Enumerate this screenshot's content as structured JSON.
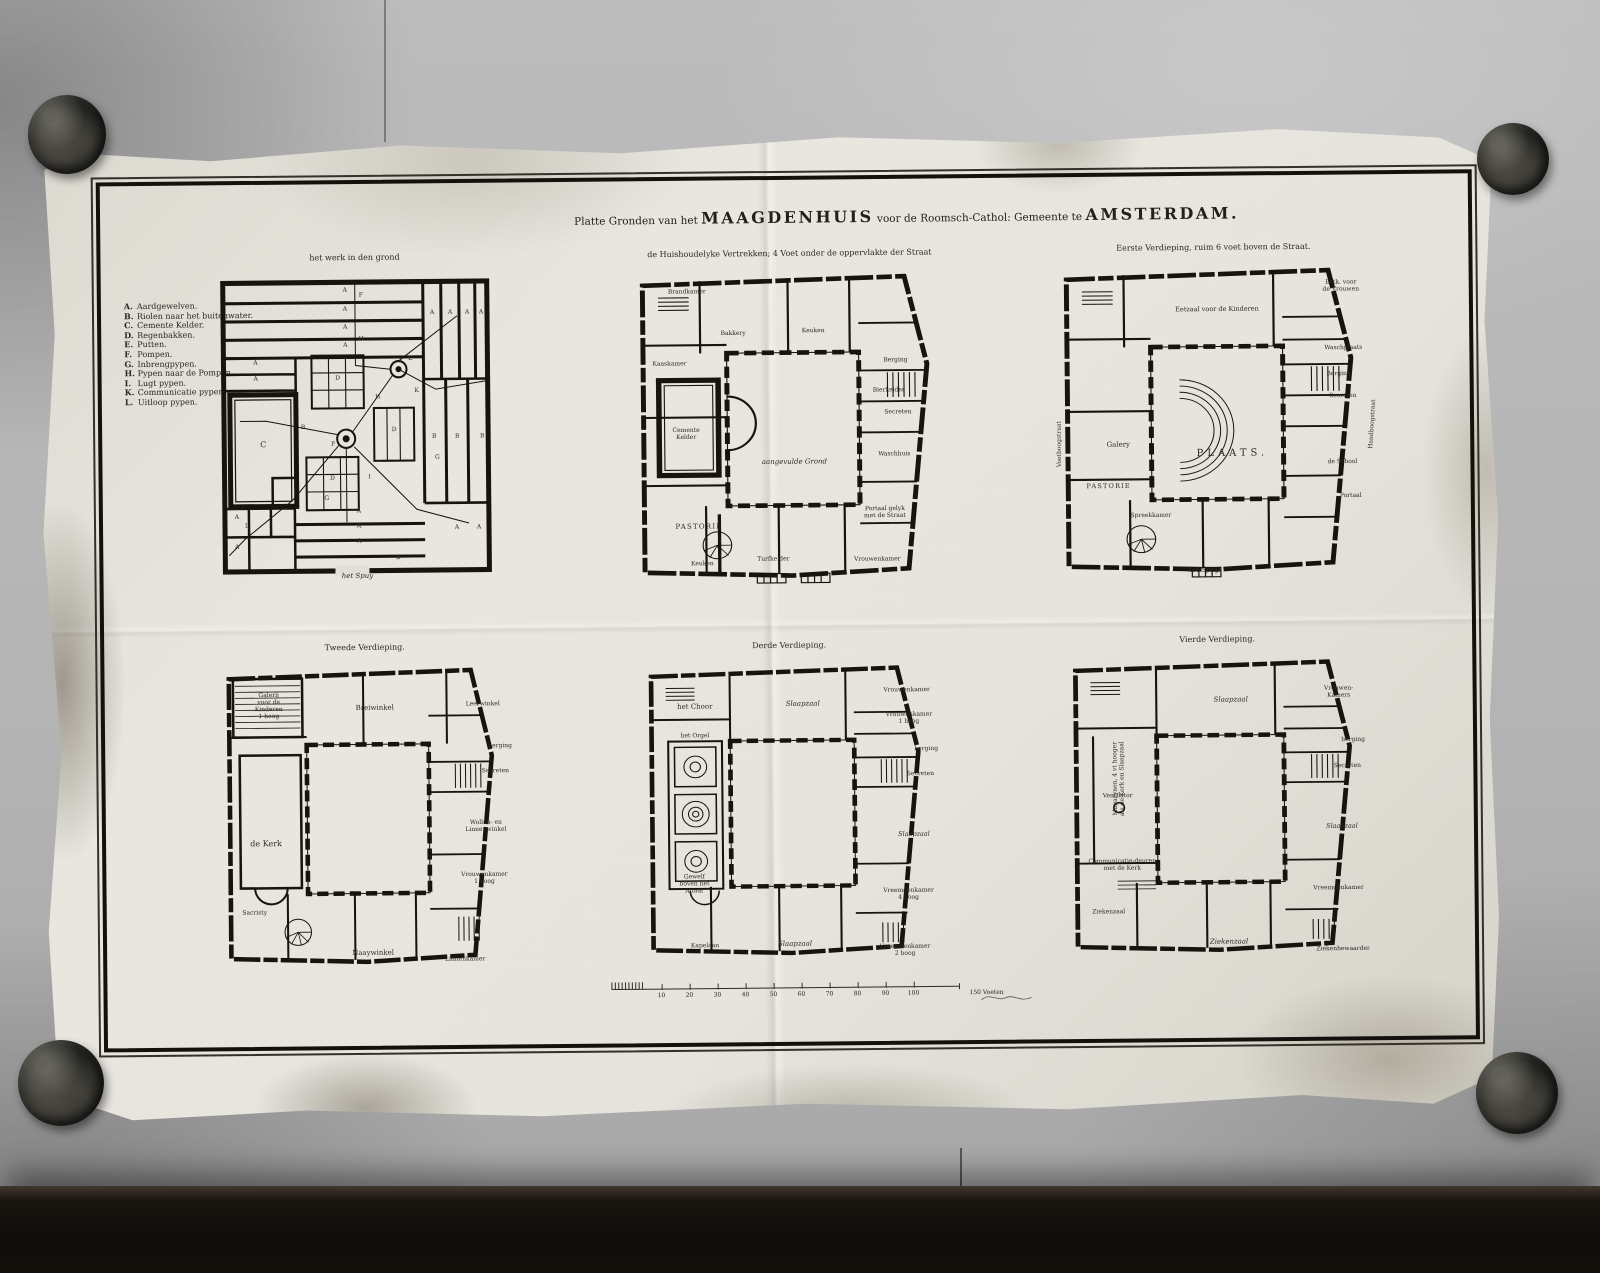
{
  "colors": {
    "paper": "#e7e5de",
    "ink": "#17140f",
    "wall": "#b4b4b4"
  },
  "sheet": {
    "title": {
      "part1": "Platte Gronden van het",
      "name1": "MAAGDENHUIS",
      "part2": "voor de Roomsch-Cathol: Gemeente te",
      "name2": "AMSTERDAM."
    },
    "legend": {
      "items": [
        {
          "key": "A.",
          "label": "Aardgewelven."
        },
        {
          "key": "B.",
          "label": "Riolen naar het buitenwater."
        },
        {
          "key": "C.",
          "label": "Cemente Kelder."
        },
        {
          "key": "D.",
          "label": "Regenbakken."
        },
        {
          "key": "E.",
          "label": "Putten."
        },
        {
          "key": "F.",
          "label": "Pompen."
        },
        {
          "key": "G.",
          "label": "Inbrengpypen."
        },
        {
          "key": "H.",
          "label": "Pypen naar de Pompen."
        },
        {
          "key": "I.",
          "label": "Lugt pypen."
        },
        {
          "key": "K.",
          "label": "Communicatie pypen."
        },
        {
          "key": "L.",
          "label": "Uitloop pypen."
        }
      ]
    },
    "plans": [
      {
        "title": "het werk in den grond",
        "labels": [
          {
            "t": "A",
            "x": 140,
            "y": 23
          },
          {
            "t": "A",
            "x": 140,
            "y": 42
          },
          {
            "t": "A",
            "x": 140,
            "y": 60
          },
          {
            "t": "A",
            "x": 140,
            "y": 78
          },
          {
            "t": "A",
            "x": 227,
            "y": 46
          },
          {
            "t": "A",
            "x": 245,
            "y": 46
          },
          {
            "t": "A",
            "x": 262,
            "y": 46
          },
          {
            "t": "A",
            "x": 276,
            "y": 46
          },
          {
            "t": "A",
            "x": 50,
            "y": 95
          },
          {
            "t": "A",
            "x": 50,
            "y": 111
          },
          {
            "t": "B",
            "x": 228,
            "y": 170
          },
          {
            "t": "B",
            "x": 251,
            "y": 170
          },
          {
            "t": "B",
            "x": 276,
            "y": 170
          },
          {
            "t": "B",
            "x": 97,
            "y": 160
          },
          {
            "t": "C",
            "x": 57,
            "y": 176,
            "fs": 8
          },
          {
            "t": "D",
            "x": 132,
            "y": 111
          },
          {
            "t": "D",
            "x": 126,
            "y": 211
          },
          {
            "t": "D",
            "x": 188,
            "y": 163
          },
          {
            "t": "E",
            "x": 205,
            "y": 92
          },
          {
            "t": "F",
            "x": 127,
            "y": 177
          },
          {
            "t": "F",
            "x": 156,
            "y": 28
          },
          {
            "t": "H",
            "x": 156,
            "y": 72
          },
          {
            "t": "G",
            "x": 120,
            "y": 231
          },
          {
            "t": "H",
            "x": 172,
            "y": 130
          },
          {
            "t": "K",
            "x": 211,
            "y": 124
          },
          {
            "t": "G",
            "x": 231,
            "y": 191
          },
          {
            "t": "L",
            "x": 40,
            "y": 258
          },
          {
            "t": "I",
            "x": 163,
            "y": 210
          },
          {
            "t": "A",
            "x": 152,
            "y": 244
          },
          {
            "t": "A",
            "x": 152,
            "y": 259
          },
          {
            "t": "A",
            "x": 152,
            "y": 274
          },
          {
            "t": "A",
            "x": 30,
            "y": 249
          },
          {
            "t": "A",
            "x": 30,
            "y": 279
          },
          {
            "t": "A",
            "x": 250,
            "y": 261
          },
          {
            "t": "A",
            "x": 272,
            "y": 261
          },
          {
            "t": "B",
            "x": 191,
            "y": 291
          },
          {
            "t": "het Spuy",
            "x": 150,
            "y": 308,
            "fs": 7,
            "cls": "it"
          }
        ]
      },
      {
        "title": "de Huishoudelyke Vertrekken; 4 Voet onder de oppervlakte der Straat",
        "labels": [
          {
            "t": "Brandkamer",
            "x": 62,
            "y": 28
          },
          {
            "t": "Bakkery",
            "x": 108,
            "y": 70
          },
          {
            "t": "Keuken",
            "x": 188,
            "y": 68
          },
          {
            "t": "Kaaskamer",
            "x": 44,
            "y": 100
          },
          {
            "t": "Berging",
            "x": 270,
            "y": 98
          },
          {
            "t": "Bierkelder",
            "x": 263,
            "y": 128
          },
          {
            "t": "Secreten",
            "x": 272,
            "y": 150
          },
          {
            "t": "Waschhuis",
            "x": 268,
            "y": 192
          },
          {
            "t": "Cemente\nKelder",
            "x": 60,
            "y": 170
          },
          {
            "t": "aangevulde Grond",
            "x": 168,
            "y": 198,
            "fs": 7,
            "cls": "it"
          },
          {
            "t": "PASTORIE",
            "x": 72,
            "y": 262,
            "cls": "caps",
            "fs": 7
          },
          {
            "t": "Portaal gelyk\nmet de Straat",
            "x": 258,
            "y": 250
          },
          {
            "t": "Keuken",
            "x": 75,
            "y": 300
          },
          {
            "t": "Turfkelder",
            "x": 146,
            "y": 296
          },
          {
            "t": "Vrouwenkamer",
            "x": 250,
            "y": 297
          }
        ]
      },
      {
        "title": "Eerste Verdieping, ruim 6 voet boven de Straat.",
        "labels": [
          {
            "t": "Eetzaal voor de Kinderen",
            "x": 168,
            "y": 52,
            "fs": 6.5
          },
          {
            "t": "Eetk. voor\nde Vrouwen",
            "x": 292,
            "y": 30
          },
          {
            "t": "Waschplaats",
            "x": 294,
            "y": 92
          },
          {
            "t": "Berging",
            "x": 289,
            "y": 118
          },
          {
            "t": "Secreten",
            "x": 293,
            "y": 140
          },
          {
            "t": "Galery",
            "x": 68,
            "y": 186,
            "fs": 7
          },
          {
            "t": "PLAATS.",
            "x": 182,
            "y": 196,
            "fs": 10,
            "sp": 4
          },
          {
            "t": "de School",
            "x": 292,
            "y": 206
          },
          {
            "t": "Voetboogstraat",
            "x": 10,
            "y": 185,
            "r": -90,
            "fs": 6
          },
          {
            "t": "Handboogstraat",
            "x": 323,
            "y": 168,
            "r": -86,
            "fs": 6
          },
          {
            "t": "PASTORIE",
            "x": 58,
            "y": 228,
            "cls": "caps",
            "fs": 6.5
          },
          {
            "t": "Spreekkamer",
            "x": 100,
            "y": 258
          },
          {
            "t": "Portaal",
            "x": 300,
            "y": 240
          },
          {
            "t": "het Spuy",
            "x": 152,
            "y": 312,
            "fs": 7,
            "cls": "it"
          }
        ]
      },
      {
        "title": "Tweede Verdieping.",
        "labels": [
          {
            "t": "Galerij\nvoor de\nKinderen\n1 hoog",
            "x": 56,
            "y": 48,
            "fs": 6
          },
          {
            "t": "Breiwinkel",
            "x": 162,
            "y": 50,
            "fs": 7
          },
          {
            "t": "Leerwinkel",
            "x": 270,
            "y": 48
          },
          {
            "t": "berging",
            "x": 287,
            "y": 90
          },
          {
            "t": "Secreten",
            "x": 282,
            "y": 115
          },
          {
            "t": "de Kerk",
            "x": 52,
            "y": 185,
            "fs": 8
          },
          {
            "t": "Wollen- en\nLinnenwinkel",
            "x": 272,
            "y": 170
          },
          {
            "t": "Vrouwenkamer\n1 hoog",
            "x": 270,
            "y": 222
          },
          {
            "t": "Sacristy",
            "x": 40,
            "y": 255
          },
          {
            "t": "Naaywinkel",
            "x": 158,
            "y": 295,
            "fs": 7
          },
          {
            "t": "Linnenkamer",
            "x": 250,
            "y": 303
          }
        ]
      },
      {
        "title": "Derde Verdieping.",
        "labels": [
          {
            "t": "het Choor",
            "x": 60,
            "y": 50,
            "fs": 7
          },
          {
            "t": "het Orgel",
            "x": 60,
            "y": 80
          },
          {
            "t": "Slaapzaal",
            "x": 168,
            "y": 48,
            "fs": 7,
            "cls": "it"
          },
          {
            "t": "Vrouwenkamer",
            "x": 272,
            "y": 36
          },
          {
            "t": "Vrouwenkamer\n1 hoog",
            "x": 274,
            "y": 64
          },
          {
            "t": "berging",
            "x": 291,
            "y": 95
          },
          {
            "t": "Secreten",
            "x": 285,
            "y": 120
          },
          {
            "t": "Slaapzaal",
            "x": 278,
            "y": 180,
            "fs": 6.5,
            "cls": "it"
          },
          {
            "t": "Gewelf\nboven het\nAltaar",
            "x": 58,
            "y": 228
          },
          {
            "t": "Kapelaan",
            "x": 68,
            "y": 290
          },
          {
            "t": "Slaapzaal",
            "x": 158,
            "y": 288,
            "fs": 7,
            "cls": "it"
          },
          {
            "t": "Vreemdenkamer\n4 hoog",
            "x": 272,
            "y": 240
          },
          {
            "t": "Vreemdenkamer\n2 hoog",
            "x": 268,
            "y": 296
          }
        ]
      },
      {
        "title": "Vierde Verdieping.",
        "labels": [
          {
            "t": "Magazynen, 4 vt hooger\nals de Kerk en Slaapzaal",
            "x": 60,
            "y": 128,
            "r": -90,
            "fs": 6
          },
          {
            "t": "Slaapzaal",
            "x": 172,
            "y": 50,
            "fs": 7,
            "cls": "it"
          },
          {
            "t": "Vrouwen-\nKamers",
            "x": 280,
            "y": 44
          },
          {
            "t": "berging",
            "x": 294,
            "y": 92
          },
          {
            "t": "Secreten",
            "x": 288,
            "y": 118
          },
          {
            "t": "Ventilator",
            "x": 58,
            "y": 146
          },
          {
            "t": "Slaapzaal",
            "x": 282,
            "y": 178,
            "fs": 6.5,
            "cls": "it"
          },
          {
            "t": "Communicatie-deuren\nmet de Kerk",
            "x": 62,
            "y": 215
          },
          {
            "t": "Ziekenzaal",
            "x": 48,
            "y": 262
          },
          {
            "t": "Ziekenzaal",
            "x": 168,
            "y": 292,
            "fs": 7,
            "cls": "it"
          },
          {
            "t": "Vreemdenkamer",
            "x": 278,
            "y": 240
          },
          {
            "t": "Ziekenbewaarder",
            "x": 282,
            "y": 301
          }
        ]
      }
    ],
    "scale": {
      "numbers": [
        {
          "t": "10",
          "x": 58
        },
        {
          "t": "20",
          "x": 86
        },
        {
          "t": "30",
          "x": 114
        },
        {
          "t": "40",
          "x": 142
        },
        {
          "t": "50",
          "x": 170
        },
        {
          "t": "60",
          "x": 198
        },
        {
          "t": "70",
          "x": 226
        },
        {
          "t": "80",
          "x": 254
        },
        {
          "t": "90",
          "x": 282
        },
        {
          "t": "100",
          "x": 310
        }
      ],
      "end_label": "150 Voeten"
    }
  }
}
